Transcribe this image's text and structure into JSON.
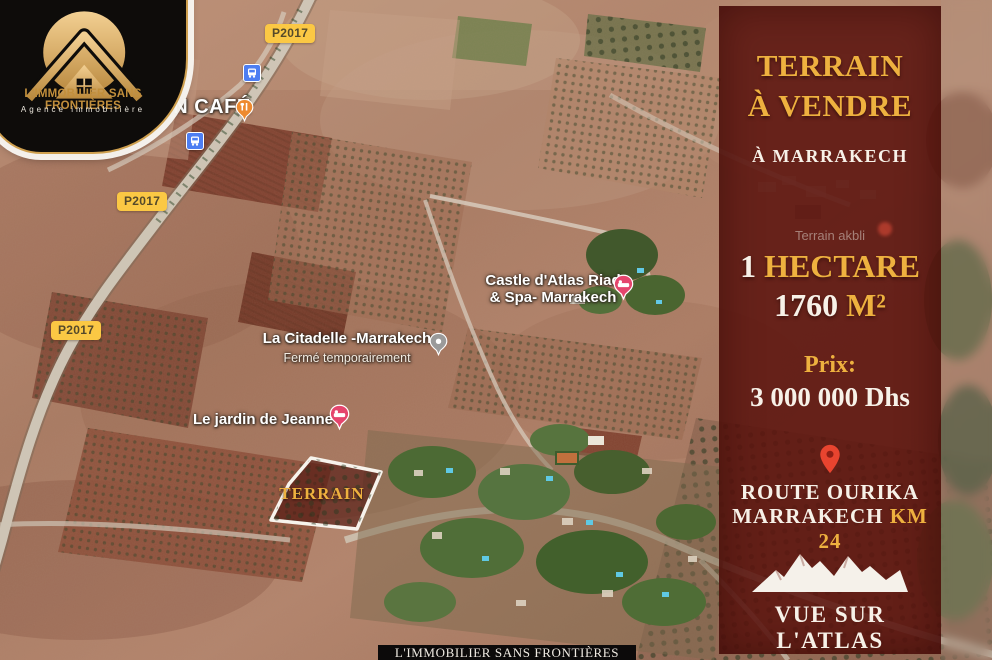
{
  "brand": {
    "name": "L'IMMOBILIER SANS FRONTIÈRES",
    "tagline": "Agence immobilière",
    "footer": "L'IMMOBILIER SANS FRONTIÈRES"
  },
  "panel": {
    "title_line1": "TERRAIN",
    "title_line2": "À VENDRE",
    "subtitle": "À MARRAKECH",
    "area_value": "1",
    "area_unit": "HECTARE",
    "size_value": "1760",
    "size_unit": "M²",
    "price_label": "Prix:",
    "price_value": "3 000 000 Dhs",
    "location_line1": "ROUTE OURIKA",
    "location_line2_white": "MARRAKECH",
    "location_line2_gold": "KM 24",
    "view_label": "VUE SUR L'ATLAS",
    "colors": {
      "gold": "#eeb13f",
      "maroon": "#5c140f",
      "text": "#f7f1e8"
    }
  },
  "map": {
    "plot_label": "TERRAIN",
    "road_badges": [
      {
        "label": "P2017"
      },
      {
        "label": "P2017"
      },
      {
        "label": "P2017"
      }
    ],
    "pois": {
      "cafe": {
        "name": "DAN CAFÉ"
      },
      "castle": {
        "line1": "Castle d'Atlas Riad",
        "line2": "& Spa- Marrakech"
      },
      "citadelle": {
        "name": "La Citadelle -Marrakech",
        "status": "Fermé temporairement"
      },
      "jardin": {
        "name": "Le jardin de Jeanne"
      },
      "area_label": {
        "name": "Terrain akbli"
      }
    }
  }
}
